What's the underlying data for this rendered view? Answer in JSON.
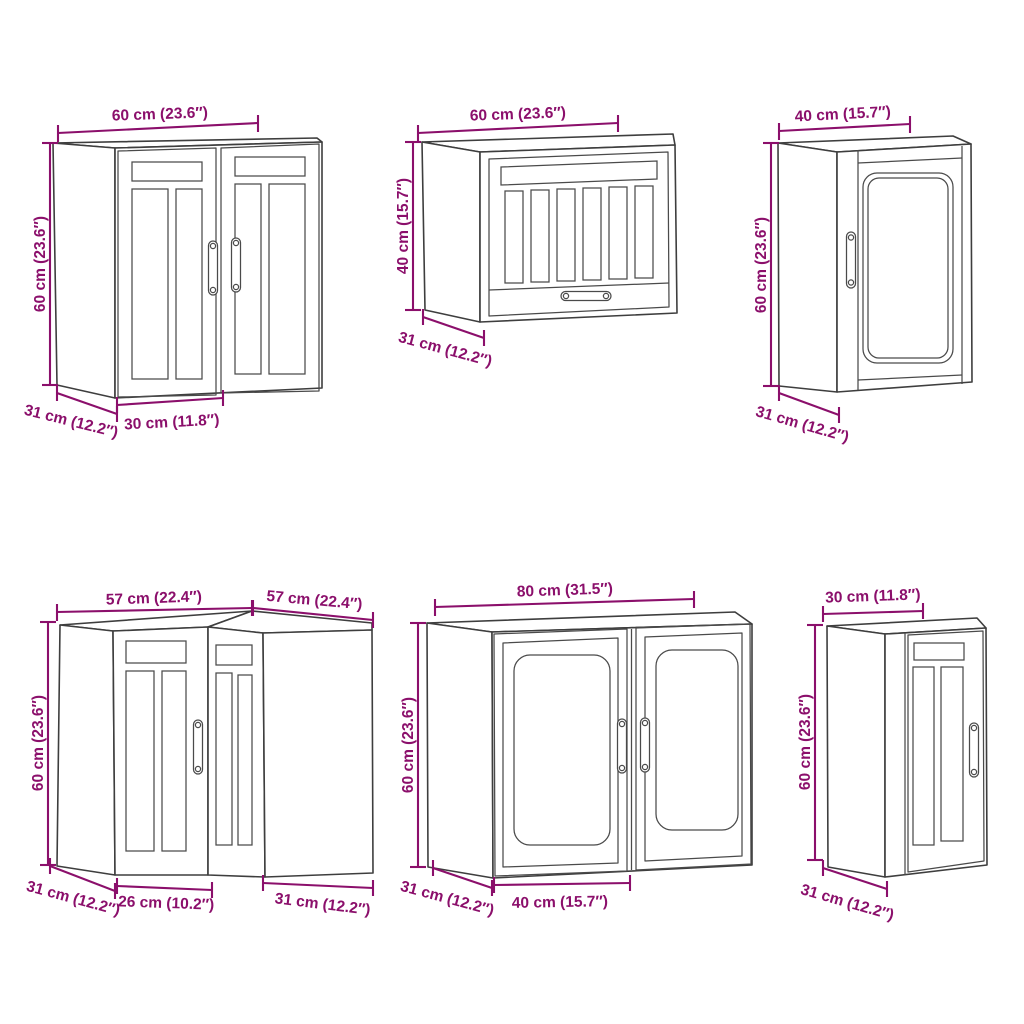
{
  "colors": {
    "dimension": "#8b0f6b",
    "outline": "#3e3e3e",
    "background": "#ffffff"
  },
  "cabinets": [
    {
      "id": "wall-cabinet-two-doors",
      "position": "top-left",
      "dims": {
        "width": "60 cm (23.6″)",
        "height": "60 cm (23.6″)",
        "depth": "31 cm (12.2″)",
        "door": "30 cm (11.8″)"
      }
    },
    {
      "id": "wall-cabinet-horizontal-glass",
      "position": "top-center",
      "dims": {
        "width": "60 cm (23.6″)",
        "height": "40 cm (15.7″)",
        "depth": "31 cm (12.2″)"
      }
    },
    {
      "id": "wall-cabinet-glass-door",
      "position": "top-right",
      "dims": {
        "width": "40 cm (15.7″)",
        "height": "60 cm (23.6″)",
        "depth": "31 cm (12.2″)"
      }
    },
    {
      "id": "corner-wall-cabinet",
      "position": "bottom-left",
      "dims": {
        "width_left": "57 cm (22.4″)",
        "width_right": "57 cm (22.4″)",
        "height": "60 cm (23.6″)",
        "depth_left": "31 cm (12.2″)",
        "door": "26 cm (10.2″)",
        "depth_right": "31 cm (12.2″)"
      }
    },
    {
      "id": "wall-cabinet-two-glass-doors",
      "position": "bottom-center",
      "dims": {
        "width": "80 cm (31.5″)",
        "height": "60 cm (23.6″)",
        "depth": "31 cm (12.2″)",
        "door": "40 cm (15.7″)"
      }
    },
    {
      "id": "wall-cabinet-narrow",
      "position": "bottom-right",
      "dims": {
        "width": "30 cm (11.8″)",
        "height": "60 cm (23.6″)",
        "depth": "31 cm (12.2″)"
      }
    }
  ]
}
